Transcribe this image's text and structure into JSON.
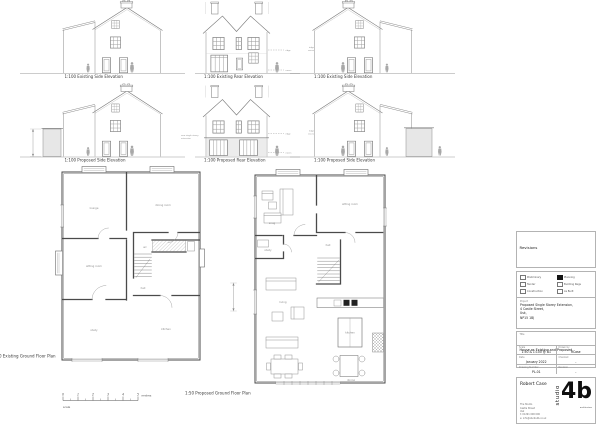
{
  "captions": {
    "r1c1": "1:100 Existing Side Elevation",
    "r1c2": "1:100 Existing Rear Elevation",
    "r1c3": "1:100 Existing Side Elevation",
    "r2c1": "1:100 Proposed Side Elevation",
    "r2c2": "1:100 Proposed Rear Elevation",
    "r2c3": "1:100 Proposed Side Elevation",
    "plan_existing": "1:50 Existing Ground Floor Plan",
    "plan_proposed": "1:50 Proposed Ground Floor Plan"
  },
  "annotations": {
    "ridge": "ridge",
    "eaves": "eaves",
    "note_line1": "new single storey",
    "note_line2": "extension"
  },
  "scale_bar": {
    "ticks": [
      "0",
      "1",
      "2",
      "3",
      "4",
      "5"
    ],
    "unit": "metres",
    "caption": "scale"
  },
  "rooms": {
    "existing": {
      "r1": "lounge",
      "r2": "dining room",
      "r3": "sitting room",
      "r4": "hall",
      "r5": "study",
      "r6": "kitchen",
      "r7": "wc"
    },
    "proposed": {
      "r1": "snug",
      "r2": "sitting room",
      "r3": "study",
      "r4": "hall",
      "r5": "living",
      "r6": "kitchen",
      "r7": "dining"
    }
  },
  "title_block": {
    "revisions_label": "Revisions",
    "status_items": [
      {
        "label": "Preliminary",
        "checked": false
      },
      {
        "label": "Planning",
        "checked": true
      },
      {
        "label": "Tender",
        "checked": false
      },
      {
        "label": "Building Regs",
        "checked": false
      },
      {
        "label": "Construction",
        "checked": false
      },
      {
        "label": "As Built",
        "checked": false
      }
    ],
    "project_label": "Project",
    "project_lines": [
      "Proposed Single Storey Extension,",
      "4 Castle Street,",
      "Usk,",
      "NP15 1BJ"
    ],
    "title_label": "Title",
    "title_value": "House as Existing and Proposed",
    "scale_label": "Scale",
    "scale_value": "1:50 & 1:100 @ A1",
    "drawn_label": "Drawn by",
    "drawn_value": "RCase",
    "date_label": "Date",
    "date_value": "January 2022",
    "checked_label": "Checked",
    "checked_value": "-",
    "number_label": "Drawing Number",
    "number_value": "PL-01",
    "revision_label": "Revision",
    "revision_value": "-",
    "architect": {
      "name": "Robert Case",
      "address_lines": [
        "The Studio",
        "Castle Street",
        "Usk",
        "t: 01291 000 000",
        "e: info@studio4b.co.uk"
      ],
      "logo_vertical": "studio",
      "logo_main": "4b",
      "logo_sub": "architecture"
    }
  }
}
